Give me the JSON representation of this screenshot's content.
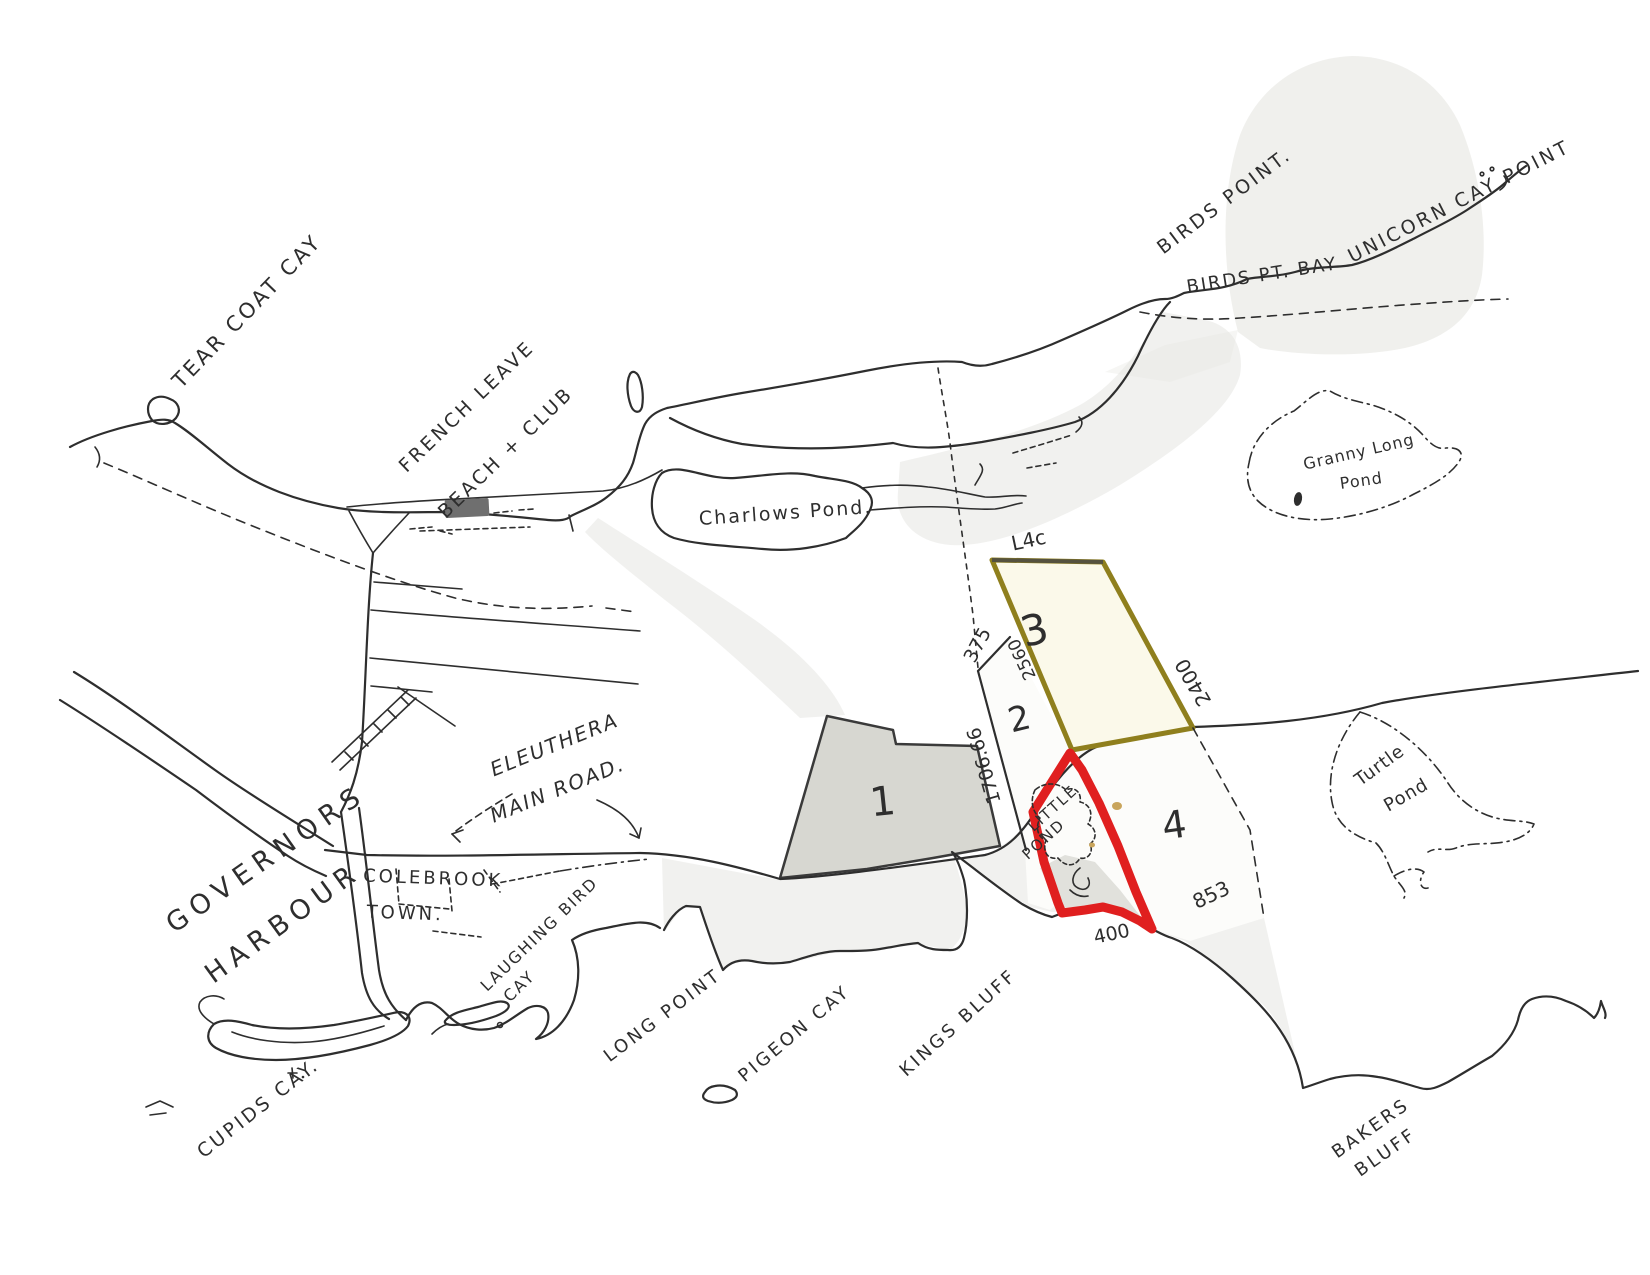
{
  "labels": {
    "tear_coat_cay": "TEAR COAT CAY",
    "french_leave": "FRENCH LEAVE",
    "beach_club": "BEACH + CLUB",
    "charlows_pond": "Charlows Pond.",
    "birds_point": "BIRDS POINT.",
    "birds_pt_bay": "BIRDS PT. BAY",
    "unicorn_cay_point": "UNICORN CAY POINT",
    "granny_long": "Granny Long",
    "granny_pond": "Pond",
    "turtle": "Turtle",
    "turtle_pond": "Pond",
    "eleuthera": "ELEUTHERA",
    "main_road": "MAIN ROAD.",
    "governors": "GOVERNORS",
    "harbour": "HARBOUR",
    "colebrook": "COLEBROOK",
    "town": "TOWN.",
    "laughing_bird": "LAUGHING BIRD",
    "laughing_bird_cay": "CAY",
    "cupids_cay": "CUPIDS CAY.",
    "long_point": "LONG POINT",
    "pigeon_cay": "PIGEON CAY",
    "kings_bluff": "KINGS BLUFF",
    "bakers": "BAKERS",
    "bakers_bluff": "BLUFF",
    "little": "LITTLE",
    "little_pond": "POND"
  },
  "parcel_numbers": {
    "p1": "1",
    "p2": "2",
    "p3": "3",
    "p4": "4"
  },
  "measurements": {
    "l4c": "L4c",
    "m375": "375",
    "m2560": "2560",
    "m2400": "2400",
    "m1706": "1706.66",
    "m400": "400",
    "m853": "853"
  },
  "colors": {
    "ink": "#2e2e2e",
    "highlight_red": "#e01f1f",
    "parcel_yellow": "#8f7f1d",
    "olive_text": "#7d6e14",
    "wash_gray": "#e4e4df",
    "shade_gray": "#d7d7d1"
  }
}
